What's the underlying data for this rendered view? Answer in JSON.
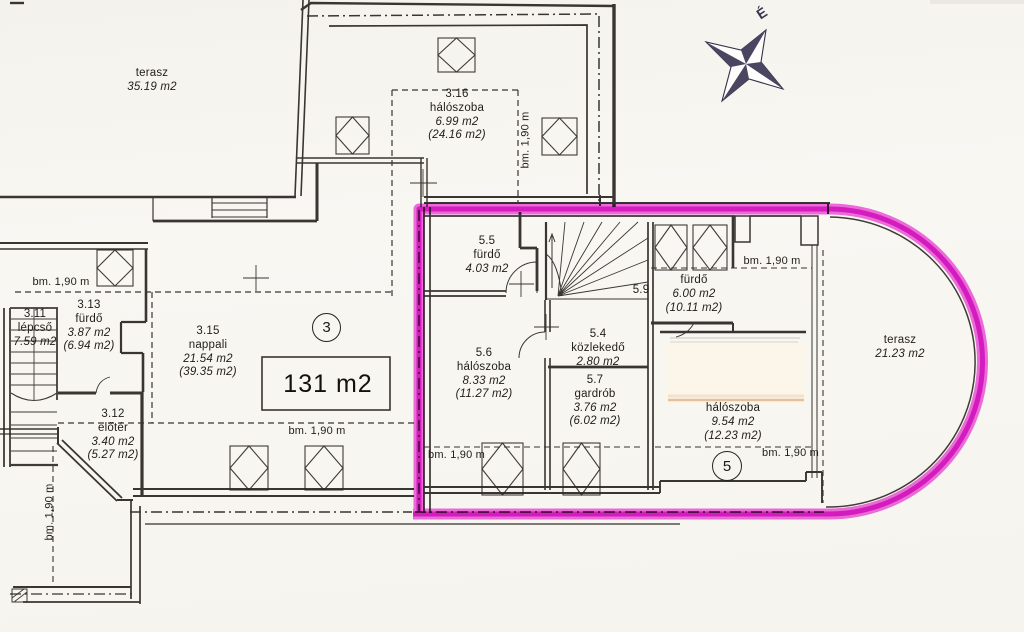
{
  "north_label": "É",
  "height_label": "bm. 1,90 m",
  "unit3": {
    "badge": "3",
    "big_area": "131 m2",
    "terasz": {
      "name": "terasz",
      "area": "35.19 m2"
    },
    "r316": {
      "id": "3.16",
      "name": "hálószoba",
      "area": "6.99 m2",
      "gross": "(24.16 m2)"
    },
    "r313": {
      "id": "3.13",
      "name": "fürdő",
      "area": "3.87 m2",
      "gross": "(6.94 m2)"
    },
    "r311": {
      "id": "3.11",
      "name": "lépcső",
      "area": "7.59 m2"
    },
    "r315": {
      "id": "3.15",
      "name": "nappali",
      "area": "21.54 m2",
      "gross": "(39.35 m2)"
    },
    "r312": {
      "id": "3.12",
      "name": "előtér",
      "area": "3.40 m2",
      "gross": "(5.27 m2)"
    }
  },
  "unit5": {
    "badge": "5",
    "r55": {
      "id": "5.5",
      "name": "fürdő",
      "area": "4.03 m2"
    },
    "r59": {
      "id": "5.9",
      "name": "fürdő",
      "area": "6.00 m2",
      "gross": "(10.11 m2)"
    },
    "r54": {
      "id": "5.4",
      "name": "közlekedő",
      "area": "2.80 m2"
    },
    "r56": {
      "id": "5.6",
      "name": "hálószoba",
      "area": "8.33 m2",
      "gross": "(11.27 m2)"
    },
    "r57": {
      "id": "5.7",
      "name": "gardrób",
      "area": "3.76 m2",
      "gross": "(6.02 m2)"
    },
    "bedroom": {
      "name": "hálószoba",
      "area": "9.54 m2",
      "gross": "(12.23 m2)"
    },
    "terasz": {
      "name": "terasz",
      "area": "21.23 m2"
    }
  },
  "colors": {
    "highlight": "#e318d2",
    "ink": "#2b2724",
    "paper": "#f7f5ef"
  }
}
